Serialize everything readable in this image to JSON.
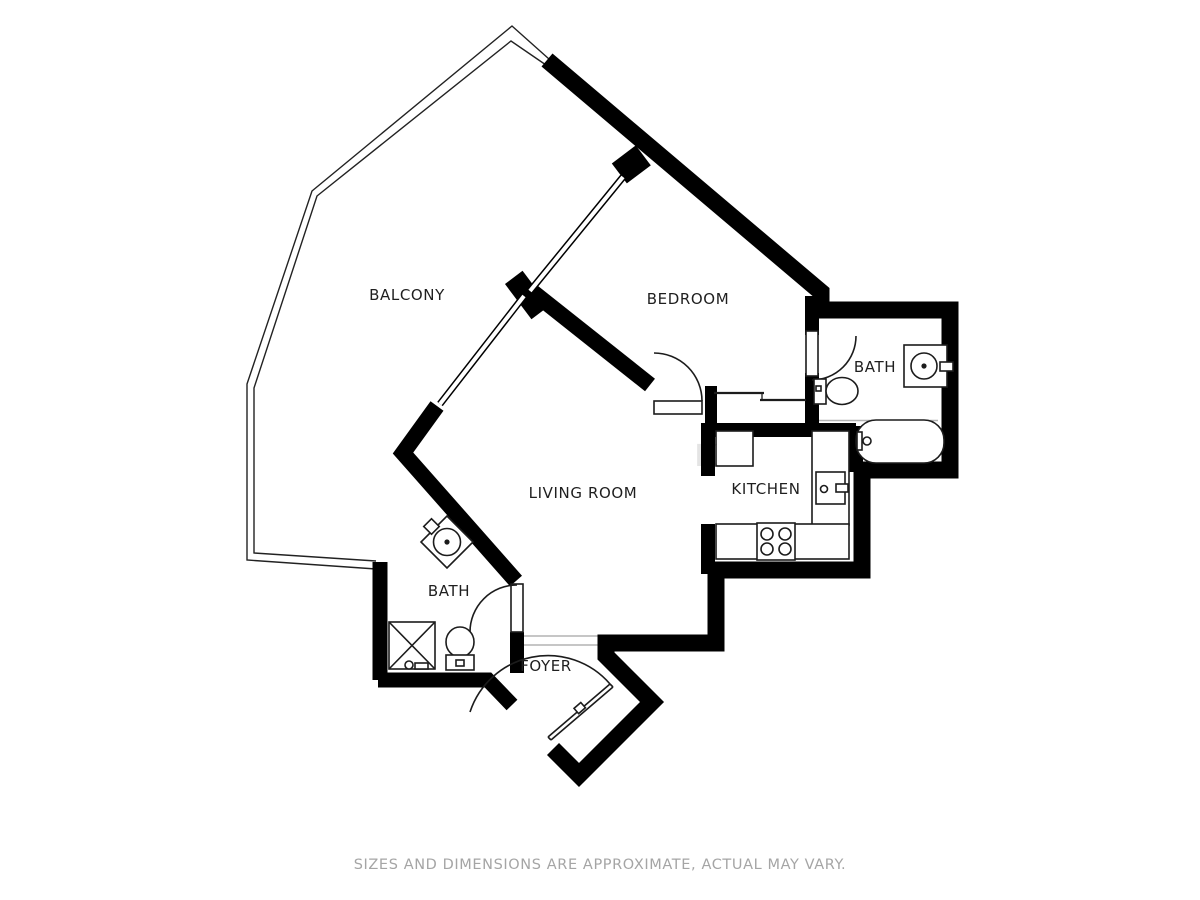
{
  "floor_plan": {
    "rooms": [
      {
        "name": "BALCONY"
      },
      {
        "name": "BEDROOM"
      },
      {
        "name": "BATH"
      },
      {
        "name": "KITCHEN"
      },
      {
        "name": "LIVING ROOM"
      },
      {
        "name": "BATH"
      },
      {
        "name": "FOYER"
      }
    ],
    "fixtures": [
      "bathtub",
      "bathroom-sink",
      "toilet",
      "shower",
      "vanity-sink",
      "kitchen-sink",
      "stove",
      "refrigerator",
      "counter",
      "hinged-doors",
      "sliding-closet-doors",
      "windows",
      "balcony-railing"
    ],
    "watermark": "K",
    "disclaimer": "SIZES AND DIMENSIONS ARE APPROXIMATE, ACTUAL MAY VARY.",
    "colors": {
      "walls": "#000000",
      "fixture_lines": "#1c1c1c",
      "labels": "#1f1f1f",
      "disclaimer_text": "#a5a5a5",
      "background": "#ffffff"
    }
  }
}
